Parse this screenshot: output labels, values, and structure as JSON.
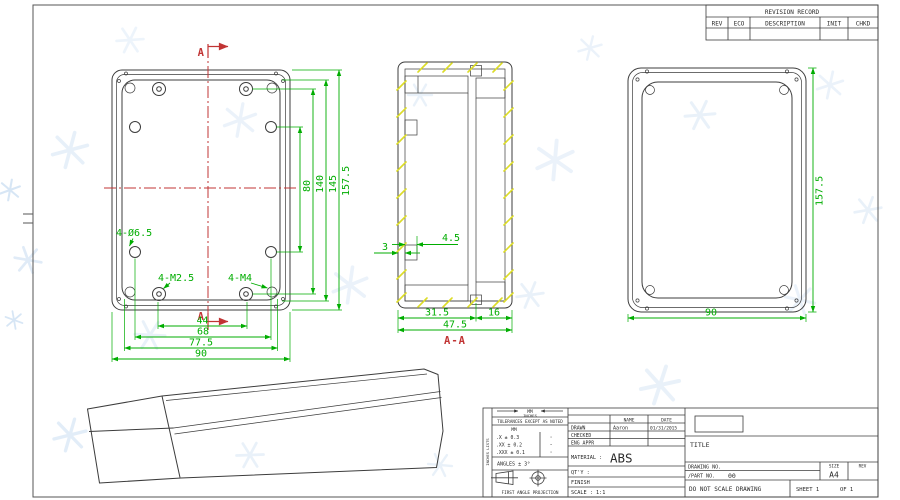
{
  "colors": {
    "line": "#3c3c3c",
    "dimension_green": "#00ad00",
    "centerline_red": "#c13434",
    "hatch_yellow": "#dcdc28",
    "watermark_blue": "#d3e3f4"
  },
  "revision_table": {
    "title": "REVISION RECORD",
    "columns": {
      "rev": "REV",
      "eco": "ECO",
      "description": "DESCRIPTION",
      "init": "INIT",
      "chkd": "CHKD"
    }
  },
  "front_view": {
    "section_letter_top": "A",
    "section_letter_bottom": "A",
    "callout_corner_holes": "4-Ø6.5",
    "callout_bosses": "4-M2.5",
    "callout_corner_posts": "4-M4",
    "dim_hole_span_v": "80",
    "dim_boss_span_v": "140",
    "dim_inner_height": "145",
    "dim_height": "157.5",
    "dim_boss_span_h": "44",
    "dim_hole_span_h": "68",
    "dim_post_span_h": "77.5",
    "dim_width": "90"
  },
  "section_view": {
    "label": "A-A",
    "dim_boss_width": "4.5",
    "dim_wall": "3",
    "dim_base_depth": "31.5",
    "dim_lid_depth": "16",
    "dim_total_depth": "47.5"
  },
  "side_view": {
    "dim_height": "157.5",
    "dim_width": "90"
  },
  "title_block": {
    "side_note": "INCHES LISTS",
    "units_mm": "MM",
    "units_inches": "INCHES",
    "tolerance_note": "TOLERANCES EXCEPT AS NOTED",
    "tol_header": "MM",
    "tol_row1": ".X ± 0.3",
    "tol_row2": ".XX ± 0.2",
    "tol_row3": ".XXX ± 0.1",
    "tol_inch1": "·",
    "tol_inch2": "·",
    "tol_inch3": "·",
    "angles": "ANGLES ± 3°",
    "projection_note": "FIRST ANGLE PROJECTION",
    "name_header": "NAME",
    "date_header": "DATE",
    "drawn_label": "DRAWN",
    "drawn_name": "Aaron",
    "drawn_date": "01/31/2015",
    "checked_label": "CHECKED",
    "eng_appr_label": "ENG APPR",
    "material_label": "MATERIAL :",
    "material_value": "ABS",
    "qty_label": "QT'Y :",
    "finish_label": "FINISH",
    "scale_label": "SCALE : 1:1",
    "title_label": "TITLE",
    "drawing_no_label": "DRAWING NO.",
    "part_no_label": "/PART NO.",
    "part_no_value": "00",
    "size_label": "SIZE",
    "size_value": "A4",
    "rev_label": "REV",
    "do_not_scale": "DO NOT SCALE DRAWING",
    "sheet_label": "SHEET 1",
    "of_label": "OF 1"
  }
}
